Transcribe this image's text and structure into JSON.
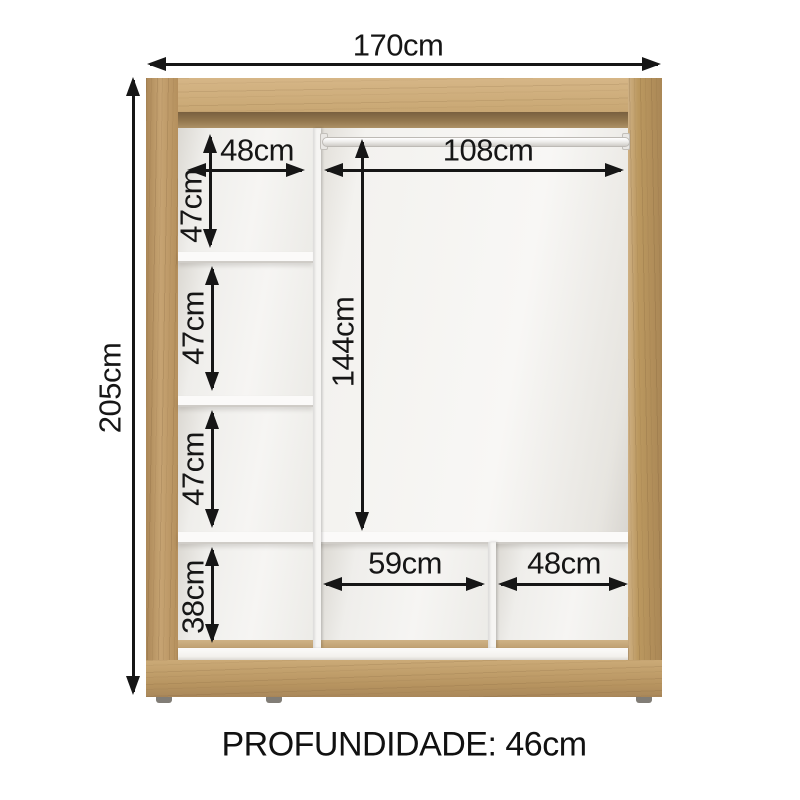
{
  "dimensions": {
    "overall_width": "170cm",
    "overall_height": "205cm",
    "left_column_width": "48cm",
    "hanging_section_width": "108cm",
    "hanging_section_height": "144cm",
    "left_column_cell_heights": [
      "47cm",
      "47cm",
      "47cm",
      "38cm"
    ],
    "bottom_cell_widths": [
      "59cm",
      "48cm"
    ],
    "depth_note": "PROFUNDIDADE: 46cm"
  },
  "colors": {
    "background": "#ffffff",
    "wood_light": "#d2b183",
    "wood_mid": "#c2a06c",
    "wood_shadow": "#7e6343",
    "interior_white": "#f7f6f3",
    "dimension_ink": "#161616"
  }
}
